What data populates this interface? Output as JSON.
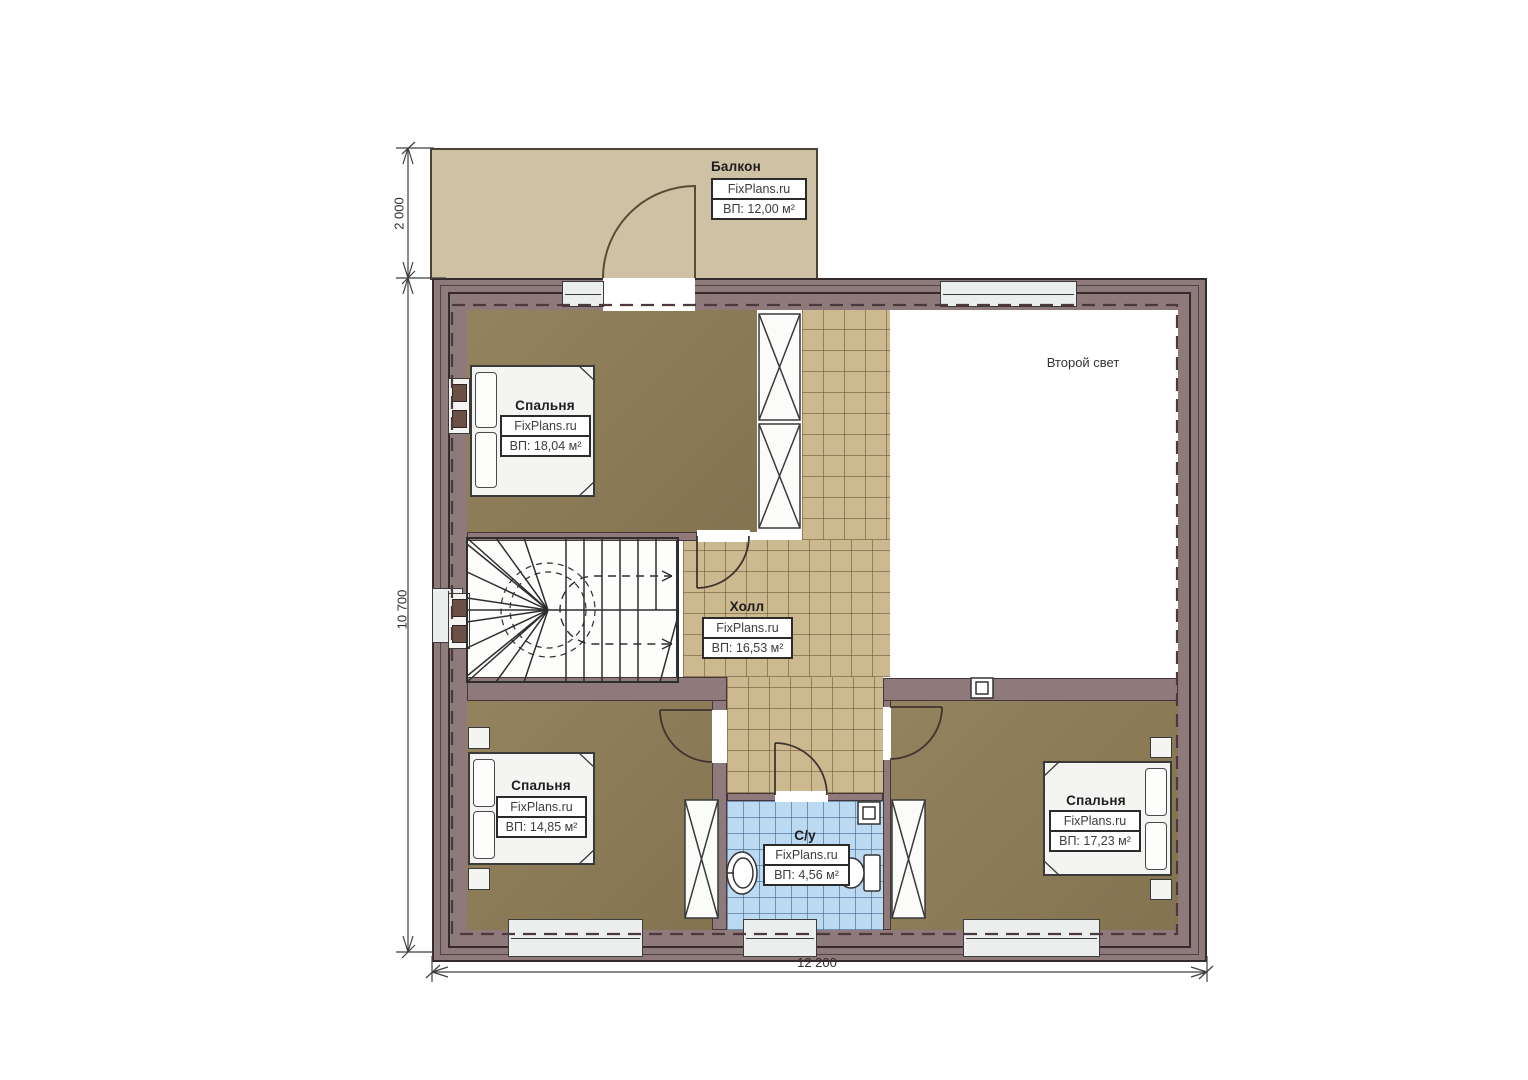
{
  "plan": {
    "balcony": {
      "name": "Балкон",
      "brand": "FixPlans.ru",
      "area": "ВП: 12,00 м²"
    },
    "bedroom_tl": {
      "name": "Спальня",
      "brand": "FixPlans.ru",
      "area": "ВП: 18,04 м²"
    },
    "hall": {
      "name": "Холл",
      "brand": "FixPlans.ru",
      "area": "ВП: 16,53 м²"
    },
    "second_light": {
      "name": "Второй свет"
    },
    "bedroom_bl": {
      "name": "Спальня",
      "brand": "FixPlans.ru",
      "area": "ВП: 14,85 м²"
    },
    "bathroom": {
      "name": "С/у",
      "brand": "FixPlans.ru",
      "area": "ВП: 4,56 м²"
    },
    "bedroom_br": {
      "name": "Спальня",
      "brand": "FixPlans.ru",
      "area": "ВП: 17,23 м²"
    },
    "dimensions": {
      "balcony_depth": "2 000",
      "left_height": "10 700",
      "bottom_width": "12 200"
    },
    "colors": {
      "wall": "#8e7a7b",
      "balcony_floor": "#cfc1a3",
      "bedroom_floor": "#8d7c56",
      "hall_tile": "#cdb990",
      "bath_tile": "#bcd9f2",
      "second_light_floor": "#ffffff"
    }
  }
}
